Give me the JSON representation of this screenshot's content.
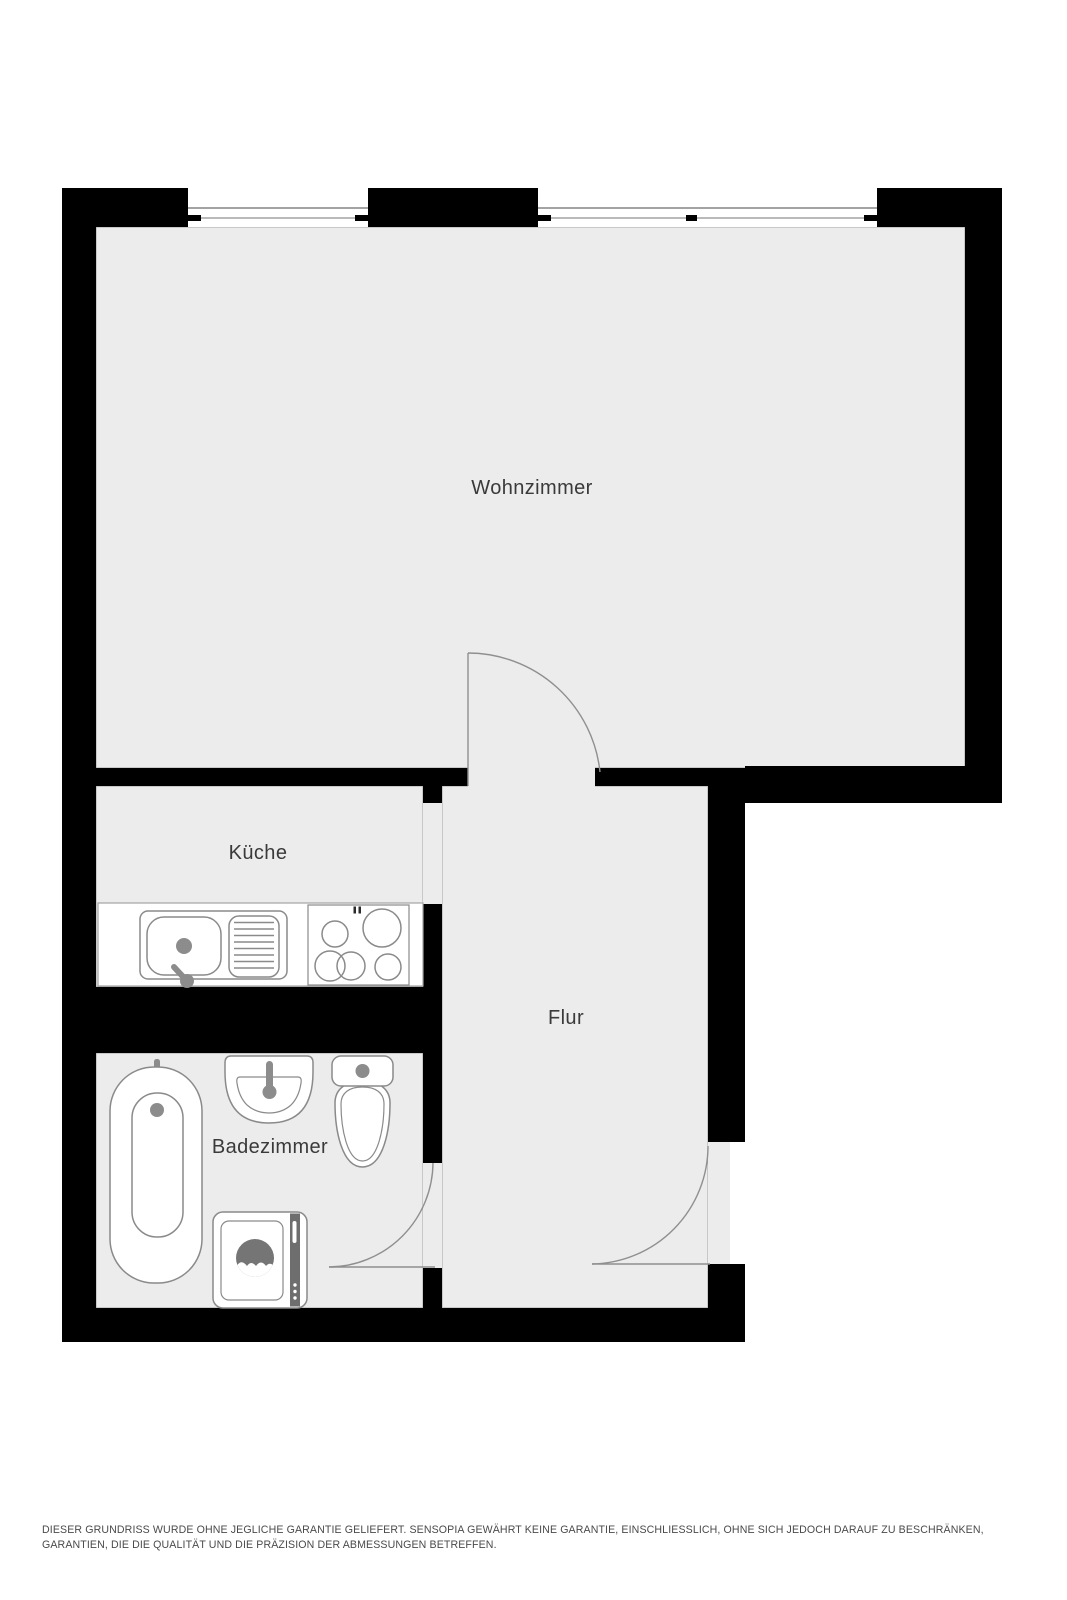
{
  "plan": {
    "rooms": {
      "wohnzimmer": {
        "label": "Wohnzimmer"
      },
      "kueche": {
        "label": "Küche"
      },
      "flur": {
        "label": "Flur"
      },
      "badezimmer": {
        "label": "Badezimmer"
      }
    },
    "fixtures": [
      "bathtub",
      "washbasin",
      "toilet",
      "washing-machine",
      "kitchen-sink",
      "dish-drainer",
      "stove",
      "window",
      "door-swing"
    ],
    "disclaimer": "DIESER GRUNDRISS WURDE OHNE JEGLICHE GARANTIE GELIEFERT. SENSOPIA GEWÄHRT KEINE GARANTIE, EINSCHLIESSLICH, OHNE SICH JEDOCH DARAUF ZU BESCHRÄNKEN, GARANTIEN, DIE DIE QUALITÄT UND DIE PRÄZISION DER ABMESSUNGEN BETREFFEN.",
    "colors": {
      "wall": "#000000",
      "floor": "#ececec",
      "floor_outline": "#a3a3a3",
      "fixture_stroke": "#8a8a8a",
      "hardware": "#8c8c8c",
      "washer_drum": "#757575",
      "washer_panel": "#6e6e6e",
      "label_text": "#3a3a3a",
      "disclaimer_text": "#4a4a4a"
    }
  }
}
